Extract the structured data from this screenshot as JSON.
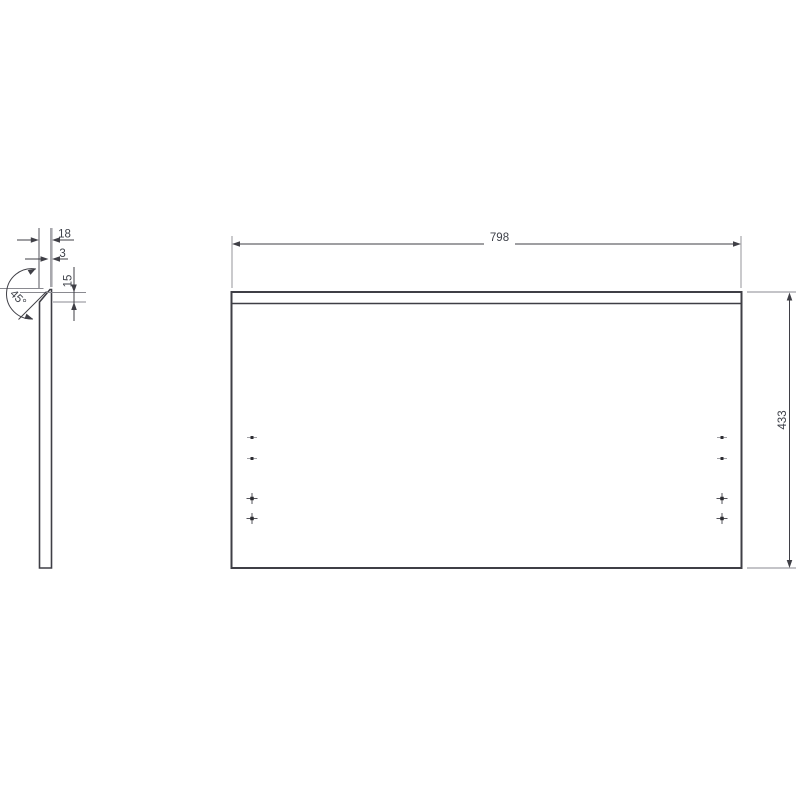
{
  "drawing": {
    "background": "#ffffff",
    "line_color": "#3f3f46",
    "thin_line_color": "#8a8a90",
    "stripe_color": "#a8a8ad",
    "marker_color": "#2e2e33",
    "text_color": "#3e4149"
  },
  "side_view": {
    "thickness_label": "18",
    "edge_flat_label": "3",
    "chamfer_height_label": "15",
    "chamfer_angle_label": "45°"
  },
  "front_view": {
    "width_label": "798",
    "height_label": "433",
    "markers": {
      "left_column_x": 252,
      "right_column_x": 722,
      "dot_rows_y": [
        437.5,
        458.5
      ],
      "cross_rows_y": [
        498.5,
        518.5
      ]
    }
  }
}
